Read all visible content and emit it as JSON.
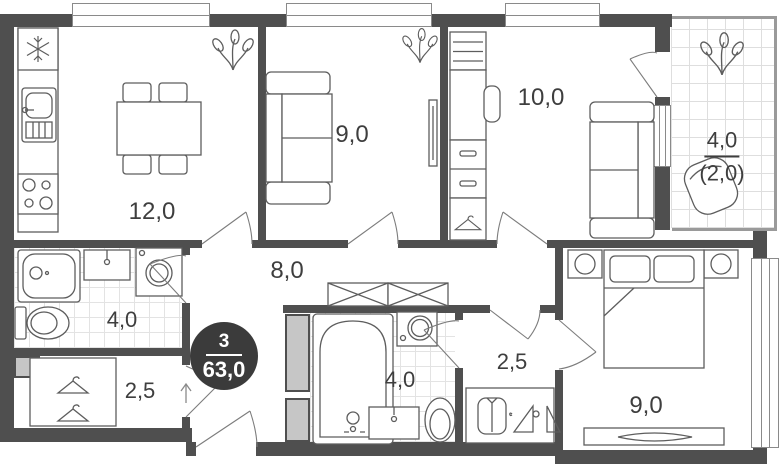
{
  "plan": {
    "type": "apartment-floor-plan",
    "badge": {
      "rooms": "3",
      "area": "63,0"
    },
    "labels": {
      "kitchen_dining": "12,0",
      "living": "9,0",
      "room_top": "10,0",
      "balcony": "4,0",
      "balcony_reduced": "(2,0)",
      "hallway": "8,0",
      "bathroom_left": "4,0",
      "storage_left": "2,5",
      "bathroom_center": "4,0",
      "corridor": "2,5",
      "bedroom": "9,0"
    },
    "colors": {
      "wall": "#4f4f4f",
      "fixture_line": "#5d5d5d",
      "tile_line": "#e3e3e3",
      "badge_bg": "#3b3b3b",
      "badge_text": "#ffffff"
    },
    "icons": [
      "snowflake",
      "plant",
      "dining-table",
      "chair",
      "sofa",
      "tv-panel",
      "shelves",
      "desk",
      "drawers",
      "wardrobe-hanger",
      "door-swing",
      "shower",
      "sink",
      "washing-machine",
      "toilet",
      "bathtub",
      "crossed-wardrobe",
      "shirt",
      "hangers",
      "bed",
      "nightstand-lamp",
      "tv-stand",
      "armchair",
      "entrance-arrow",
      "window"
    ]
  }
}
